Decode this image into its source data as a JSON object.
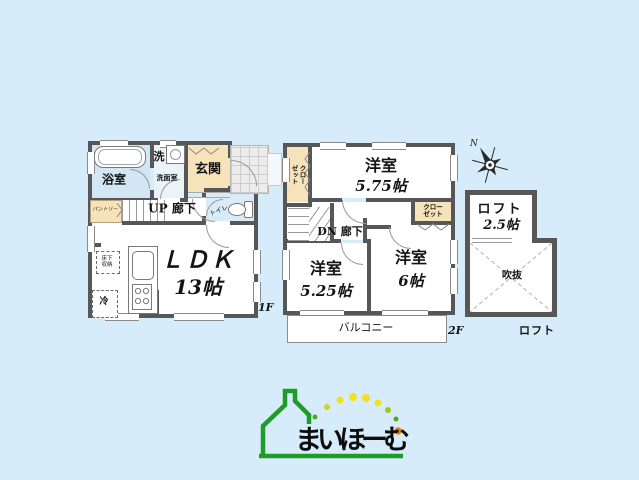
{
  "colors": {
    "bg": "#d7ecfa",
    "wall": "#575757",
    "beige": "#f6e3ba",
    "bath": "#d2e7f3",
    "green": "#1f9c28",
    "yellow": "#f2e11c",
    "ygreen": "#c0d516",
    "orange": "#f08300"
  },
  "floor1": {
    "floor_label": "1F",
    "bath_label": "浴室",
    "laundry_label": "洗",
    "washroom_label": "洗面室",
    "entrance_label": "玄関",
    "pantry_label": "パントリー",
    "hallway_label": "UP 廊下",
    "toilet_label": "トイレ",
    "ldk_label": "ＬＤＫ",
    "ldk_size": "13帖",
    "underfloor_storage_label": "床下収納",
    "fridge_label": "冷"
  },
  "floor2": {
    "floor_label": "2F",
    "closet_left_label": "クローゼット",
    "closet_right_label": "クローゼット",
    "bedroom_a_label": "洋室",
    "bedroom_a_size": "5.75帖",
    "hallway_label": "DN 廊下",
    "bedroom_b_label": "洋室",
    "bedroom_b_size": "5.25帖",
    "bedroom_c_label": "洋室",
    "bedroom_c_size": "6帖",
    "balcony_label": "バルコニー"
  },
  "loft": {
    "room_label": "ロフト",
    "room_size": "2.5帖",
    "void_label": "吹抜",
    "section_label": "ロフト"
  },
  "compass": {
    "north_label": "N"
  },
  "logo": {
    "brand_text": "まいほーむ"
  }
}
